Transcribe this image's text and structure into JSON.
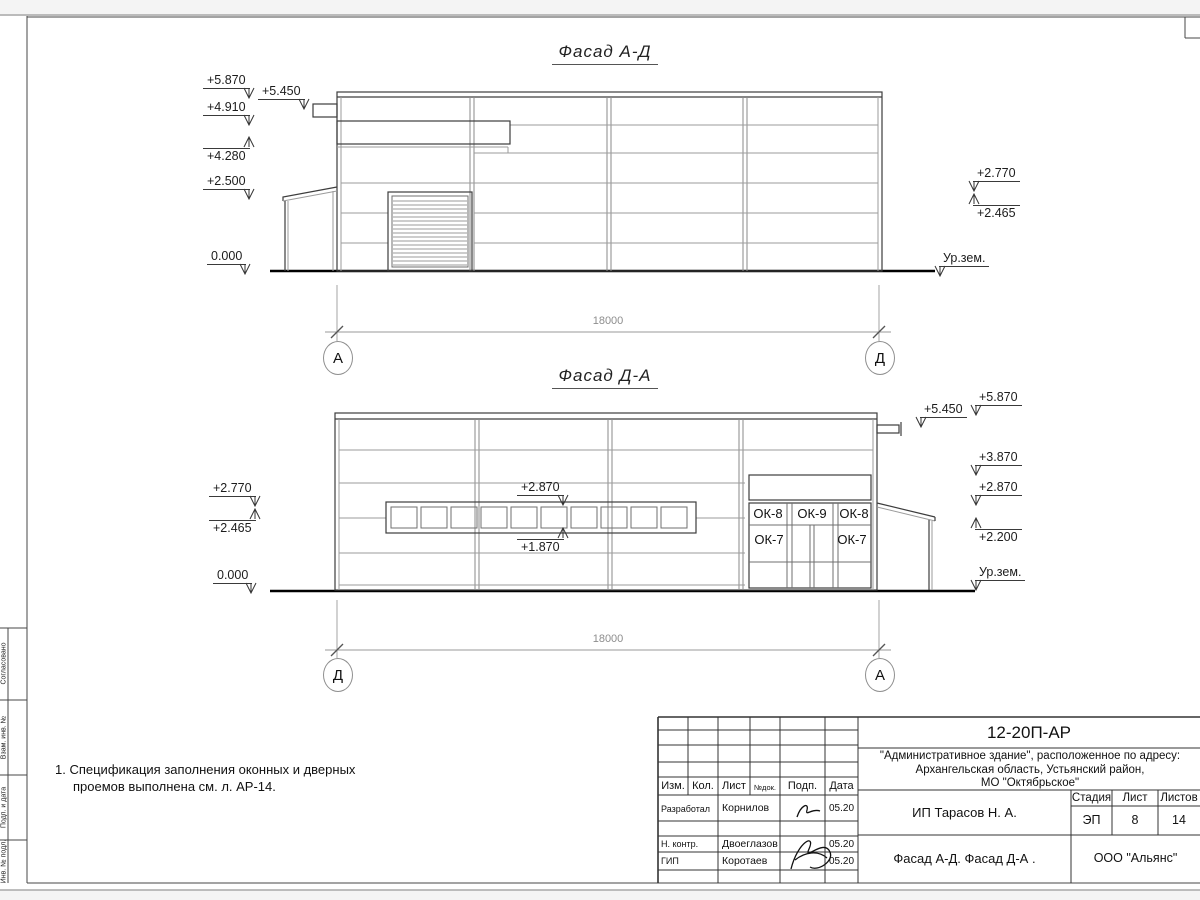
{
  "sheet": {
    "facade_top_title": "Фасад А-Д",
    "facade_bottom_title": "Фасад Д-А",
    "notes": [
      "1. Спецификация заполнения оконных и дверных",
      "проемов выполнена см. л. АР-14."
    ]
  },
  "facade_top": {
    "dim": {
      "text": "18000",
      "x": 578,
      "y": 315
    },
    "axes": [
      {
        "label": "А",
        "cx": 337,
        "cy": 357
      },
      {
        "label": "Д",
        "cx": 879,
        "cy": 357
      }
    ],
    "marks": [
      {
        "label": "+5.870",
        "x": 203,
        "y": 74,
        "dir": "down",
        "side": "right"
      },
      {
        "label": "+5.450",
        "x": 258,
        "y": 85,
        "dir": "down",
        "side": "right"
      },
      {
        "label": "+4.910",
        "x": 203,
        "y": 101,
        "dir": "down",
        "side": "right"
      },
      {
        "label": "+4.280",
        "x": 203,
        "y": 148,
        "dir": "up",
        "side": "right"
      },
      {
        "label": "+2.500",
        "x": 203,
        "y": 175,
        "dir": "down",
        "side": "right"
      },
      {
        "label": "0.000",
        "x": 207,
        "y": 250,
        "dir": "down",
        "side": "right"
      },
      {
        "label": "+2.770",
        "x": 973,
        "y": 167,
        "dir": "down",
        "side": "left"
      },
      {
        "label": "+2.465",
        "x": 973,
        "y": 205,
        "dir": "up",
        "side": "left"
      },
      {
        "label": "Ур.зем.",
        "x": 939,
        "y": 252,
        "dir": "down",
        "side": "left"
      }
    ]
  },
  "facade_bottom": {
    "dim": {
      "text": "18000",
      "x": 578,
      "y": 633
    },
    "axes": [
      {
        "label": "Д",
        "cx": 337,
        "cy": 674
      },
      {
        "label": "А",
        "cx": 879,
        "cy": 674
      }
    ],
    "marks": [
      {
        "label": "+2.770",
        "x": 209,
        "y": 482,
        "dir": "down",
        "side": "right"
      },
      {
        "label": "+2.465",
        "x": 209,
        "y": 520,
        "dir": "up",
        "side": "right"
      },
      {
        "label": "0.000",
        "x": 213,
        "y": 569,
        "dir": "down",
        "side": "right"
      },
      {
        "label": "+2.870",
        "x": 517,
        "y": 481,
        "dir": "down",
        "side": "right"
      },
      {
        "label": "+1.870",
        "x": 517,
        "y": 539,
        "dir": "up",
        "side": "right"
      },
      {
        "label": "+5.870",
        "x": 975,
        "y": 391,
        "dir": "down",
        "side": "left"
      },
      {
        "label": "+5.450",
        "x": 920,
        "y": 403,
        "dir": "down",
        "side": "left"
      },
      {
        "label": "+3.870",
        "x": 975,
        "y": 451,
        "dir": "down",
        "side": "left"
      },
      {
        "label": "+2.870",
        "x": 975,
        "y": 481,
        "dir": "down",
        "side": "left"
      },
      {
        "label": "+2.200",
        "x": 975,
        "y": 529,
        "dir": "up",
        "side": "left"
      },
      {
        "label": "Ур.зем.",
        "x": 975,
        "y": 566,
        "dir": "down",
        "side": "left"
      }
    ],
    "window_cells": [
      {
        "text": "ОК-8",
        "x": 768,
        "y": 514
      },
      {
        "text": "ОК-9",
        "x": 812,
        "y": 514
      },
      {
        "text": "ОК-8",
        "x": 854,
        "y": 514
      },
      {
        "text": "ОК-7",
        "x": 769,
        "y": 540
      },
      {
        "text": "ОК-7",
        "x": 852,
        "y": 540
      }
    ]
  },
  "left_margin": {
    "cells": [
      {
        "label": "Согласовано",
        "y1": 628,
        "y2": 700
      },
      {
        "label": "Взам. инв. №",
        "y1": 700,
        "y2": 775
      },
      {
        "label": "Подп. и дата",
        "y1": 775,
        "y2": 840
      },
      {
        "label": "Инв. № подл.",
        "y1": 840,
        "y2": 883
      }
    ]
  },
  "titleblock": {
    "doc_code": "12-20П-АР",
    "address_lines": [
      "\"Административное здание\", расположенное по адресу:",
      "Архангельская область, Устьянский район,",
      "МО \"Октябрьское\""
    ],
    "header_cols": [
      "Изм.",
      "Кол.",
      "Лист",
      "№док.",
      "Подп.",
      "Дата"
    ],
    "rows": [
      {
        "role": "Разработал",
        "name": "Корнилов",
        "date": "05.20"
      },
      {
        "role": "Н. контр.",
        "name": "Двоеглазов",
        "date": "05.20"
      },
      {
        "role": "ГИП",
        "name": "Коротаев",
        "date": "05.20"
      }
    ],
    "client": "ИП Тарасов Н. А.",
    "stage_label": "Стадия",
    "sheet_label": "Лист",
    "sheets_label": "Листов",
    "stage": "ЭП",
    "sheet_no": "8",
    "sheets_total": "14",
    "sheet_title": "Фасад А-Д. Фасад Д-А .",
    "company": "ООО \"Альянс\""
  }
}
